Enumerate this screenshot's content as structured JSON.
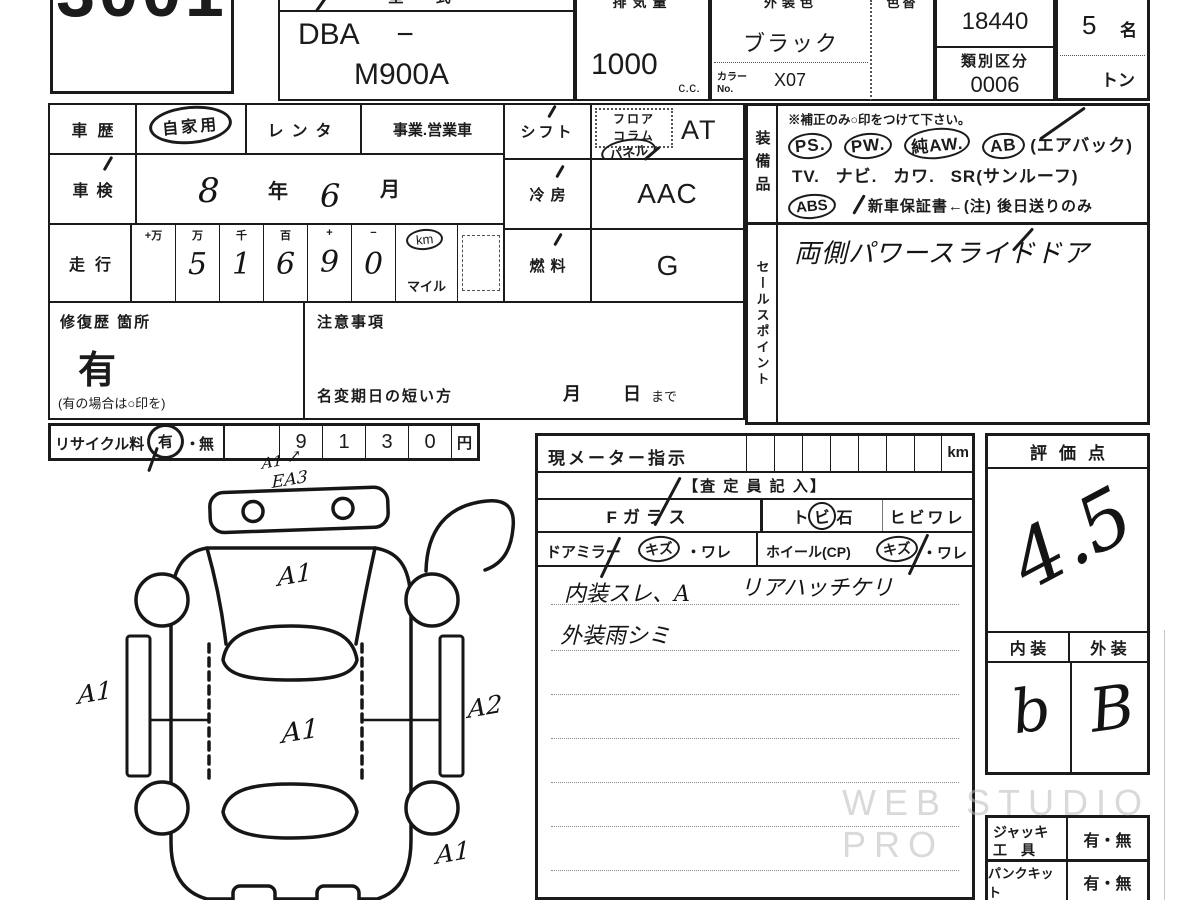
{
  "header": {
    "lot": "3001",
    "model_label": "型 式",
    "model_prefix": "DBA −",
    "model": "M900A",
    "disp_label": "排気量",
    "disp": "1000",
    "disp_unit": "c.c.",
    "color_label": "外装色",
    "color": "ブラック",
    "color_no_label1": "カラー",
    "color_no_label2": "No.",
    "color_no": "X07",
    "color_change_label": "色替",
    "katashiki_label": "類別区分",
    "katashiki_no": "18440",
    "class_no": "0006",
    "capacity": "5",
    "capacity_unit": "名",
    "load_unit": "トン"
  },
  "left": {
    "history_label": "車歴",
    "history_private": "自家用",
    "history_rental": "レンタ",
    "history_business": "事業.営業車",
    "shaken_label": "車検",
    "shaken_year": "8",
    "year_suffix": "年",
    "shaken_month": "6",
    "month_suffix": "月",
    "mileage_label": "走行",
    "mileage_headers": [
      "+万",
      "万",
      "千",
      "百",
      "+",
      "−"
    ],
    "mileage_digits": [
      "",
      "5",
      "1",
      "6",
      "9",
      "0"
    ],
    "km": "km",
    "mile": "マイル",
    "repair_label": "修復歴 箇所",
    "repair_value": "有",
    "repair_note": "(有の場合は○印を)",
    "caution_label": "注意事項",
    "rename_label": "名変期日の短い方",
    "rename_month": "月",
    "rename_day": "日",
    "rename_until": "まで",
    "recycle_label": "リサイクル料",
    "recycle_yes": "有",
    "recycle_dot": "・",
    "recycle_no": "無",
    "recycle_digits": [
      "9",
      "1",
      "3",
      "0"
    ],
    "yen": "円"
  },
  "mid": {
    "shift_label": "シフト",
    "shift_floor": "フロア",
    "shift_column": "コラム",
    "shift_panel": "パネル",
    "shift_value": "AT",
    "cool_label": "冷房",
    "cool_value": "AAC",
    "fuel_label": "燃料",
    "fuel_value": "G"
  },
  "equip": {
    "label": "装備品",
    "note": "※補正のみ○印をつけて下さい。",
    "ps": "PS.",
    "pw": "PW.",
    "aw": "純AW.",
    "ab": "AB",
    "ab_paren": "(エアバック)",
    "tv": "TV.",
    "navi": "ナビ.",
    "kawa": "カワ.",
    "sr": "SR",
    "sr_paren": "(サンルーフ)",
    "abs": "ABS",
    "warranty": "新車保証書←(注) 後日送りのみ"
  },
  "sales": {
    "label": "セールスポイント",
    "value": "両側パワースライドドア"
  },
  "meter": {
    "label": "現メーター指示",
    "unit": "km"
  },
  "assess": {
    "title": "【査 定 員 記 入】",
    "f_glass": "Fガラス",
    "tobi_left": "ト",
    "tobi_circled": "ビ",
    "tobi_right": "石",
    "hibiware": "ヒビワレ",
    "mirror_label": "ドアミラー",
    "kizu": "キズ",
    "ware": "・ワレ",
    "wheel_label": "ホイール(CP)",
    "note_line1a": "内装スレ、A",
    "note_line1b": "リアハッチケリ",
    "note_line2": "外装雨シミ"
  },
  "score": {
    "label": "評価点",
    "value": "4.5",
    "interior_label": "内 装",
    "exterior_label": "外 装",
    "interior": "b",
    "exterior": "B"
  },
  "tools": {
    "jack_label1": "ジャッキ",
    "jack_label2": "工　具",
    "jack_value": "有・無",
    "pank_label": "パンクキット",
    "pank_value": "有・無"
  },
  "diagram": {
    "mark_arrow": "↗",
    "mark_top1": "A1",
    "mark_top2": "EA3",
    "hood": "A1",
    "left": "A1",
    "center": "A1",
    "right": "A2",
    "bottom": "A1"
  },
  "watermark": "WEB STUDIO PRO"
}
